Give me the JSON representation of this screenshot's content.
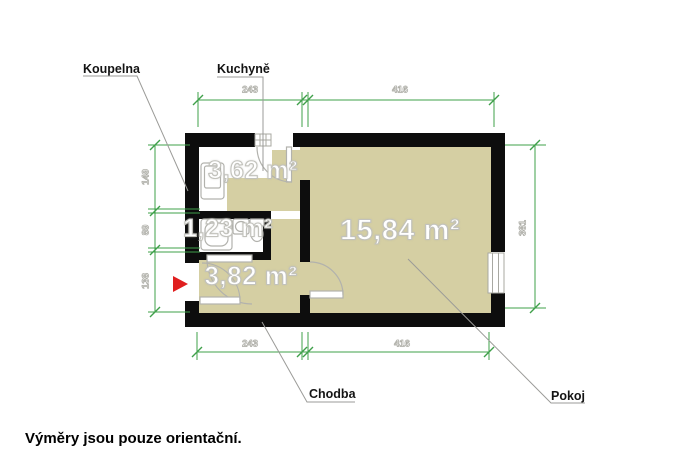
{
  "plan": {
    "rooms": {
      "kuchyne": {
        "name": "Kuchyně",
        "area": "3,62 m²"
      },
      "koupelna": {
        "name": "Koupelna",
        "area": "1,23 m²"
      },
      "chodba": {
        "name": "Chodba",
        "area": "3,82 m²"
      },
      "pokoj": {
        "name": "Pokoj",
        "area": "15,84 m²"
      }
    },
    "dimensions": {
      "top_left_width": "243",
      "top_right_width": "416",
      "bottom_left_width": "243",
      "bottom_right_width": "416",
      "left_kitchen_height": "149",
      "left_bathroom_height": "89",
      "left_hall_height": "138",
      "right_room_height": "381"
    },
    "icons": {
      "entrance_arrow": "red triangle entrance marker"
    }
  },
  "footer": {
    "note": "Výměry jsou pouze orientační."
  },
  "colors": {
    "floor": "#d5cfa3",
    "wall": "#0d0d0d",
    "dimension_green": "#3fa04a",
    "leader_gray": "#9b9b98",
    "fixture_gray": "#b2b2ad",
    "entrance_red": "#e01f1f"
  }
}
